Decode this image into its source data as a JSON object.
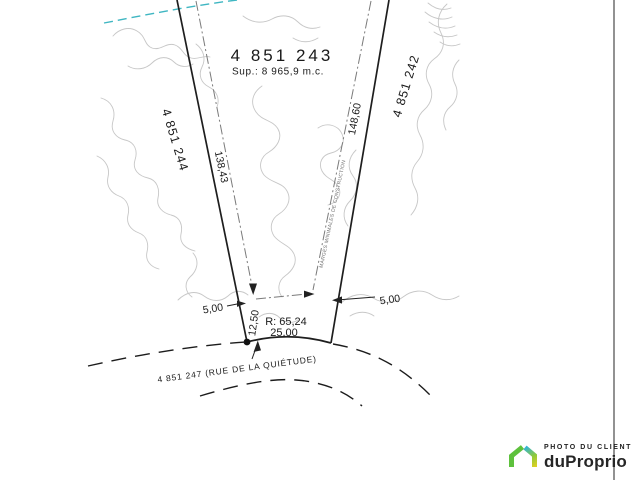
{
  "plan": {
    "main_lot": {
      "number": "4 851 243",
      "area": "Sup.: 8 965,9 m.c."
    },
    "adjacent_lot_left": "4 851 244",
    "adjacent_lot_right": "4 851 242",
    "street_lot": "4 851 247 (RUE DE LA QUIÉTUDE)",
    "dimensions": {
      "left_boundary": "138,43",
      "right_boundary": "148,60",
      "side_setback_left": "5,00",
      "side_setback_right": "5,00",
      "front_setback": "12,50",
      "radius": "R: 65,24",
      "frontage": "25,00"
    },
    "margin_note": "MARGES MINIMALES DE CONSTRUCTION"
  },
  "watermark": {
    "tagline": "PHOTO DU CLIENT",
    "brand": "duProprio",
    "colors": {
      "green": "#5ec13d",
      "blue": "#29b2e3",
      "yellow": "#ddd022",
      "text": "#262626"
    }
  },
  "colors": {
    "boundary": "#1e1e1e",
    "contour": "#c7c7c7",
    "utility_line": "#3fb6c2",
    "margin_line": "#7a7a7a"
  }
}
